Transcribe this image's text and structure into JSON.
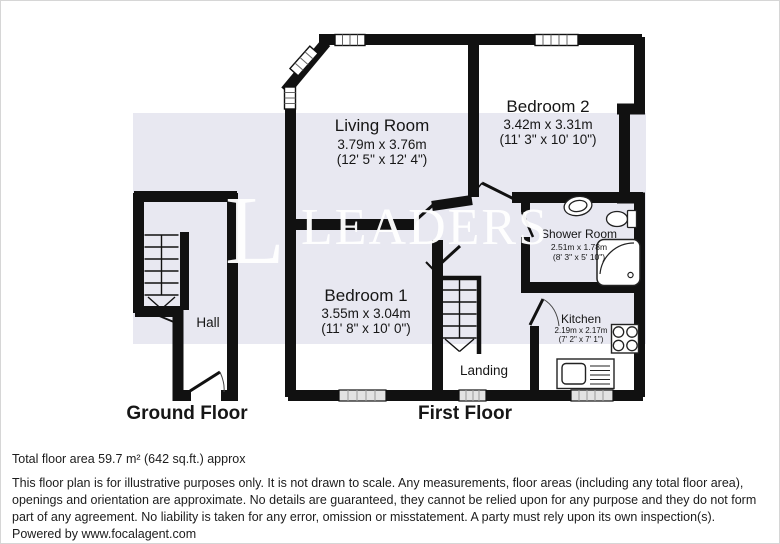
{
  "watermark": {
    "initial": "L",
    "name": "LEADERS"
  },
  "rooms": {
    "living": {
      "name": "Living Room",
      "metric": "3.79m x 3.76m",
      "imperial": "(12' 5\" x 12' 4\")"
    },
    "bed2": {
      "name": "Bedroom 2",
      "metric": "3.42m x 3.31m",
      "imperial": "(11' 3\" x 10' 10\")"
    },
    "bed1": {
      "name": "Bedroom 1",
      "metric": "3.55m x 3.04m",
      "imperial": "(11' 8\" x 10' 0\")"
    },
    "shower": {
      "name": "Shower Room",
      "metric": "2.51m x 1.78m",
      "imperial": "(8' 3\" x 5' 10\")"
    },
    "kitchen": {
      "name": "Kitchen",
      "metric": "2.19m x 2.17m",
      "imperial": "(7' 2\" x 7' 1\")"
    },
    "landing": {
      "name": "Landing"
    },
    "hall": {
      "name": "Hall"
    }
  },
  "floor_labels": {
    "ground": "Ground Floor",
    "first": "First Floor"
  },
  "footer": {
    "area_line": "Total floor area 59.7 m² (642 sq.ft.) approx",
    "disclaimer": "This floor plan is for illustrative purposes only. It is not drawn to scale. Any measurements, floor areas (including any total floor area), openings and orientation are approximate. No details are guaranteed, they cannot be relied upon for any purpose and they do not form part of any agreement. No liability is taken for any error, omission or misstatement. A party must rely upon its own inspection(s).",
    "powered_by": "Powered by www.focalagent.com"
  },
  "colors": {
    "wall": "#111111",
    "band": "#e8e8f1",
    "watermark": "#ffffff"
  }
}
